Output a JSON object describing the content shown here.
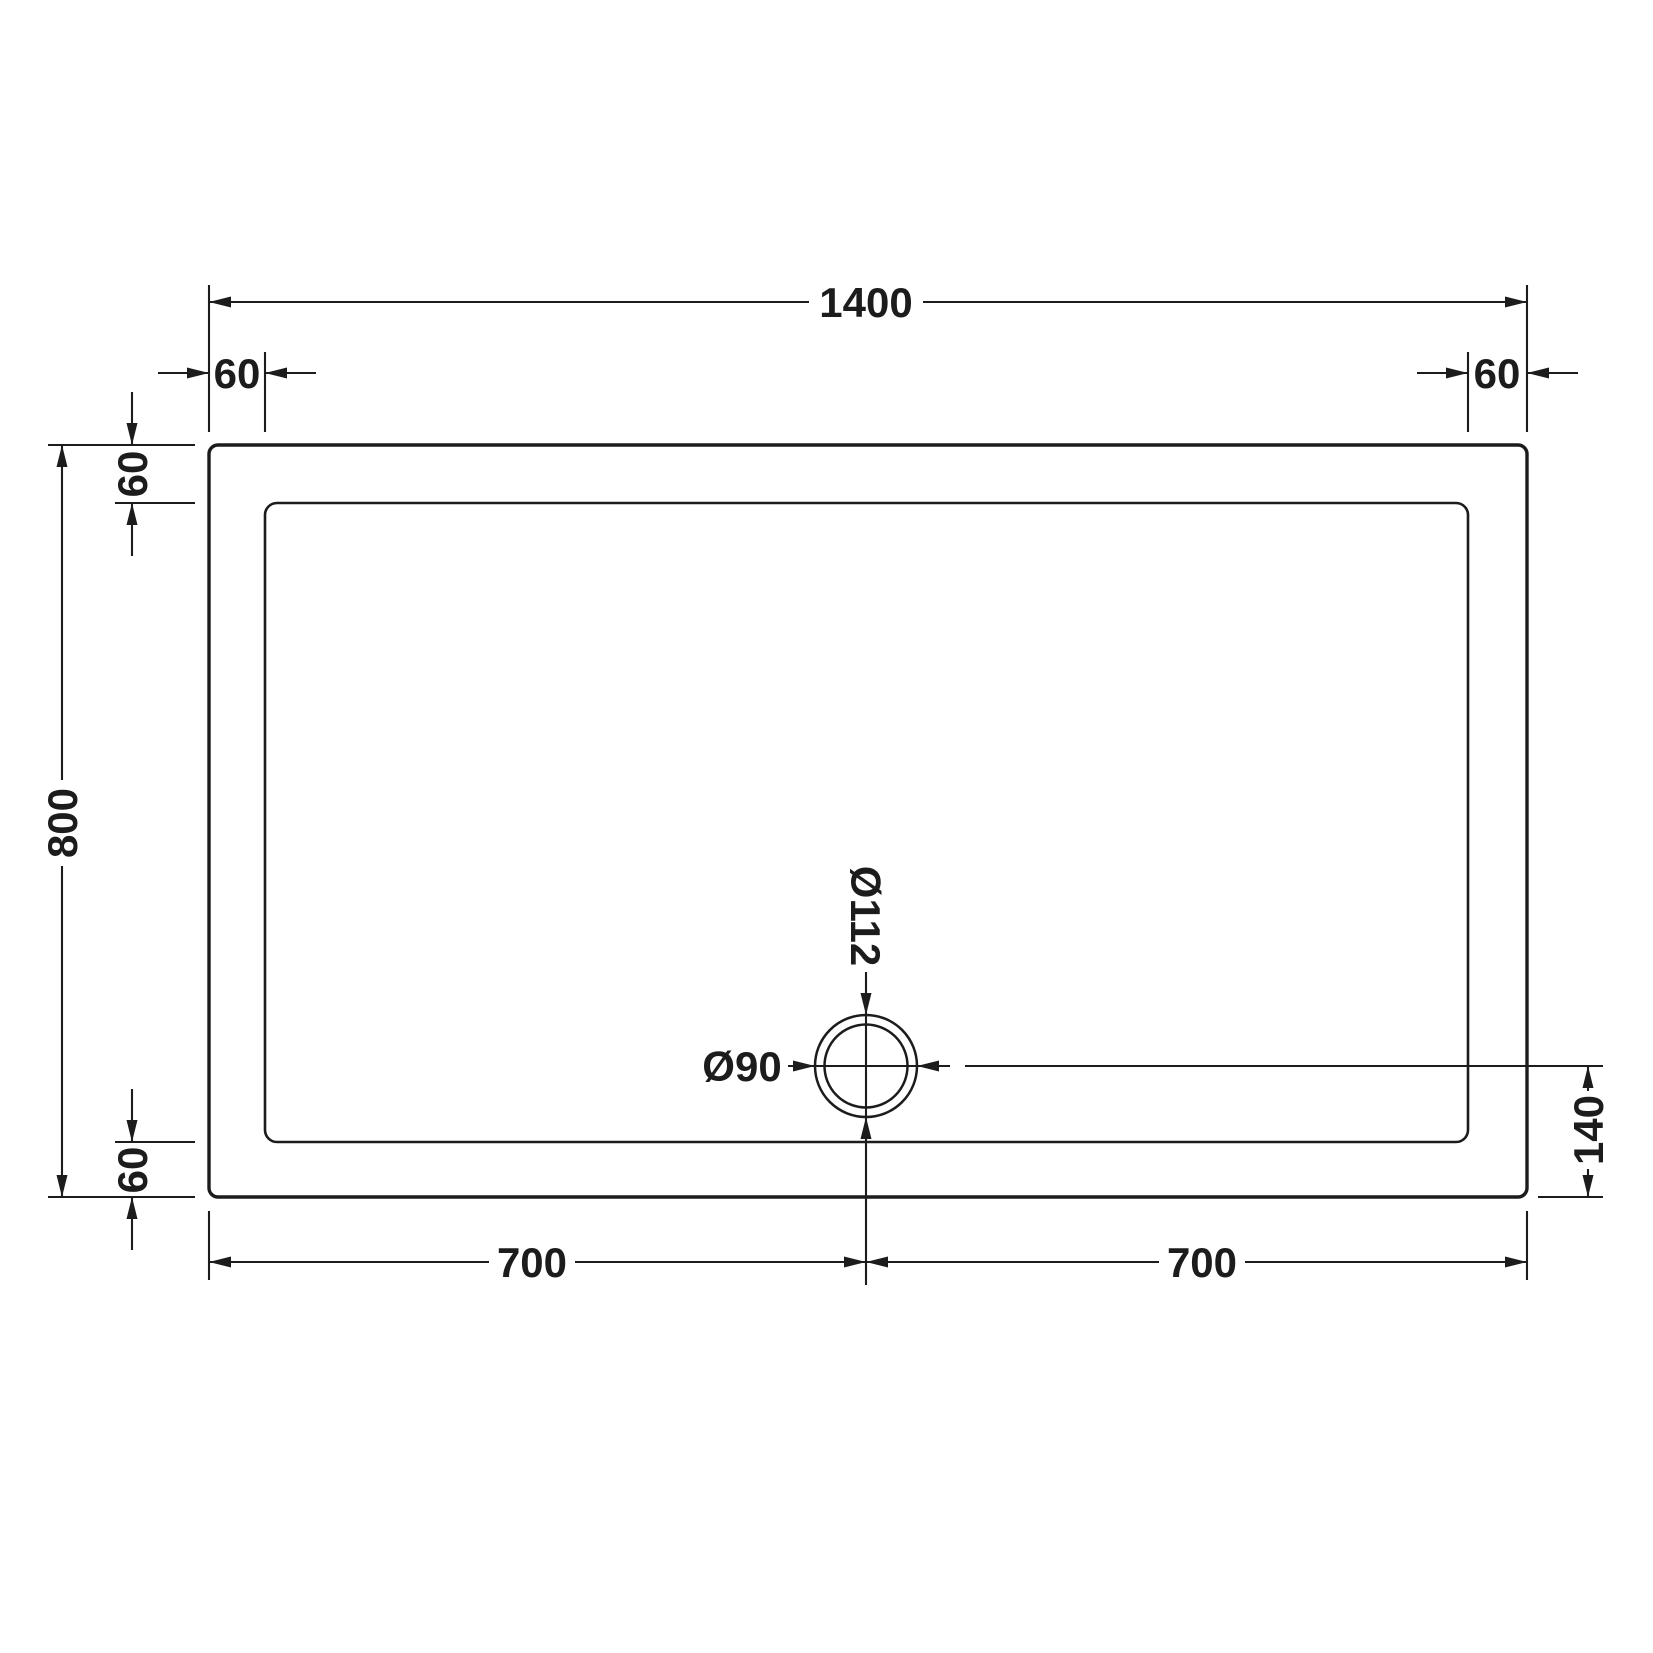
{
  "page": {
    "background": "#ffffff",
    "line_color": "#1c1c1c"
  },
  "drawing": {
    "type": "technical-plan",
    "subject": "rectangular shower tray top view with waste drain",
    "units_implied": "mm",
    "labels": {
      "overall_width": "1400",
      "overall_depth": "800",
      "edge_top_left": "60",
      "edge_top_right": "60",
      "edge_left_upper": "60",
      "edge_left_lower": "60",
      "waste_outer_dia": "Ø112",
      "waste_inner_dia": "Ø90",
      "waste_to_bottom_edge": "140",
      "bottom_span_left": "700",
      "bottom_span_right": "700"
    }
  }
}
